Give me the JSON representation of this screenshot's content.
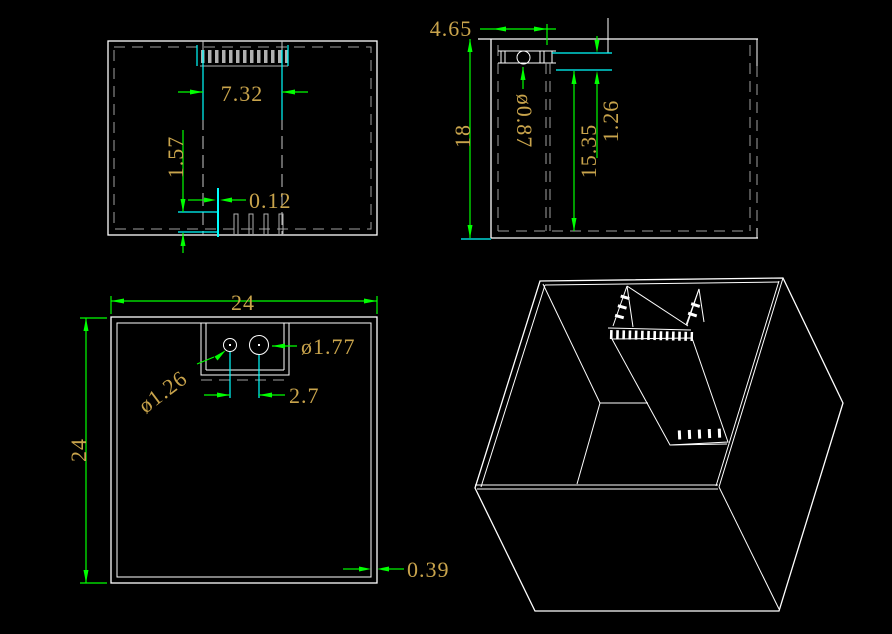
{
  "drawing": {
    "front_view": {
      "label": "front elevation of sump box with overflow weir",
      "weir_width": "7.32",
      "notch_height": "1.57",
      "plate_thickness": "0.12"
    },
    "side_view": {
      "label": "side elevation of sump box",
      "weir_offset": "4.65",
      "box_height": "18",
      "hole_diameter": "ø0.87",
      "inner_depth": "15.35",
      "top_gap": "1.26"
    },
    "plan_view": {
      "label": "plan view of sump box",
      "width": "24",
      "depth": "24",
      "small_hole_diameter": "ø1.26",
      "large_hole_diameter": "ø1.77",
      "hole_spacing": "2.7",
      "wall_thickness": "0.39"
    },
    "iso_view": {
      "label": "isometric view of open sump box with internal overflow"
    }
  },
  "colors": {
    "background": "#000000",
    "object_lines": "#FFFFFF",
    "hidden_lines": "#A0A0A0",
    "dimension_lines": "#00FF00",
    "extension_lines": "#00FFFF",
    "dimension_text": "#C9A44C"
  }
}
